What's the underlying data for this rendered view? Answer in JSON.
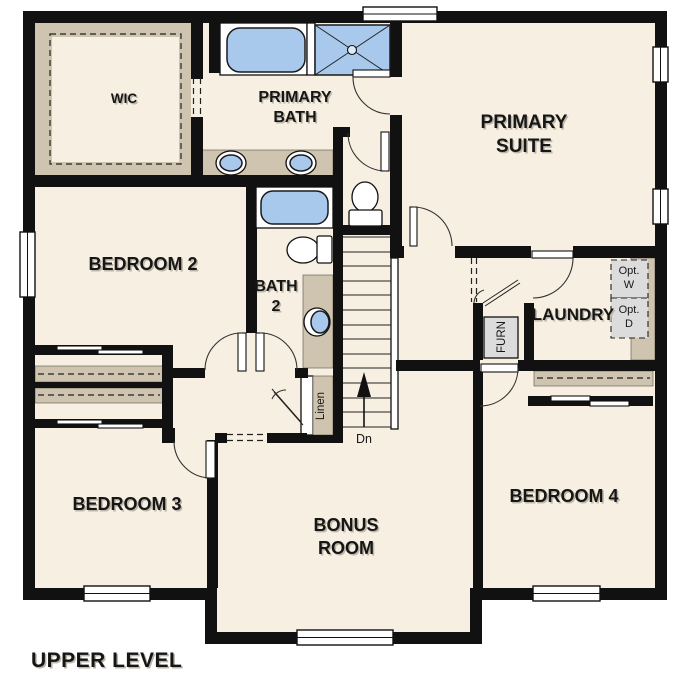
{
  "level_label": "UPPER LEVEL",
  "rooms": {
    "wic": "WIC",
    "primary_bath_1": "PRIMARY",
    "primary_bath_2": "BATH",
    "primary_suite_1": "PRIMARY",
    "primary_suite_2": "SUITE",
    "bedroom2": "BEDROOM 2",
    "bath2_1": "BATH",
    "bath2_2": "2",
    "laundry": "LAUNDRY",
    "bedroom3": "BEDROOM 3",
    "bonus_1": "BONUS",
    "bonus_2": "ROOM",
    "bedroom4": "BEDROOM 4"
  },
  "annotations": {
    "linen": "Linen",
    "furnace": "FURN",
    "opt_washer_1": "Opt.",
    "opt_washer_2": "W",
    "opt_dryer_1": "Opt.",
    "opt_dryer_2": "D",
    "stairs_down": "Dn"
  },
  "colors": {
    "background": "#ffffff",
    "floor": "#f7efe2",
    "wall": "#111111",
    "millwork_tan": "#cfc4af",
    "fixture_blue": "#a9c9ec",
    "appliance_gray": "#dcdcdc"
  }
}
